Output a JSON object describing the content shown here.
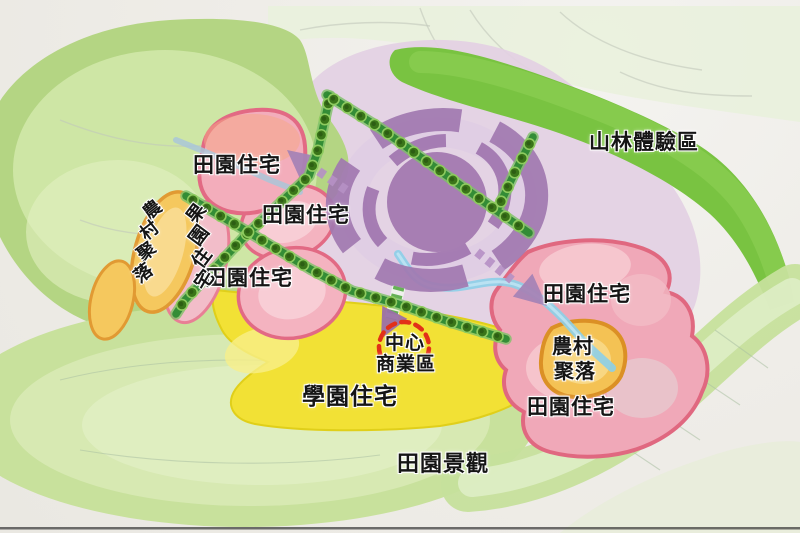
{
  "map": {
    "zone_labels": {
      "mountain_forest_zone": "山林體驗區",
      "garden_residence": "田園住宅",
      "orchard_residence": "果園住宅",
      "campus_residence": "學園住宅",
      "farm_village_settlement": "農村聚落",
      "farm_village_line1": "農村",
      "farm_village_line2": "聚落",
      "cbd_line1": "中心",
      "cbd_line2": "商業區",
      "central_business_district": "中心商業區",
      "garden_landscape": "田園景觀"
    },
    "colors": {
      "garden_residence_fill": "#f3adbb",
      "garden_residence_border": "#e26a84",
      "farm_village_fill": "#f4c254",
      "farm_village_border": "#db9025",
      "campus_yellow": "#f2e135",
      "cbd_dash_red": "#e23018",
      "ring_purple": "#a178b0",
      "boulevard_green": "#2e8a33",
      "mountain_forest_green": "#79c341",
      "landscape_green": "#cde2a4",
      "stream_blue": "#8ccfe8"
    }
  }
}
